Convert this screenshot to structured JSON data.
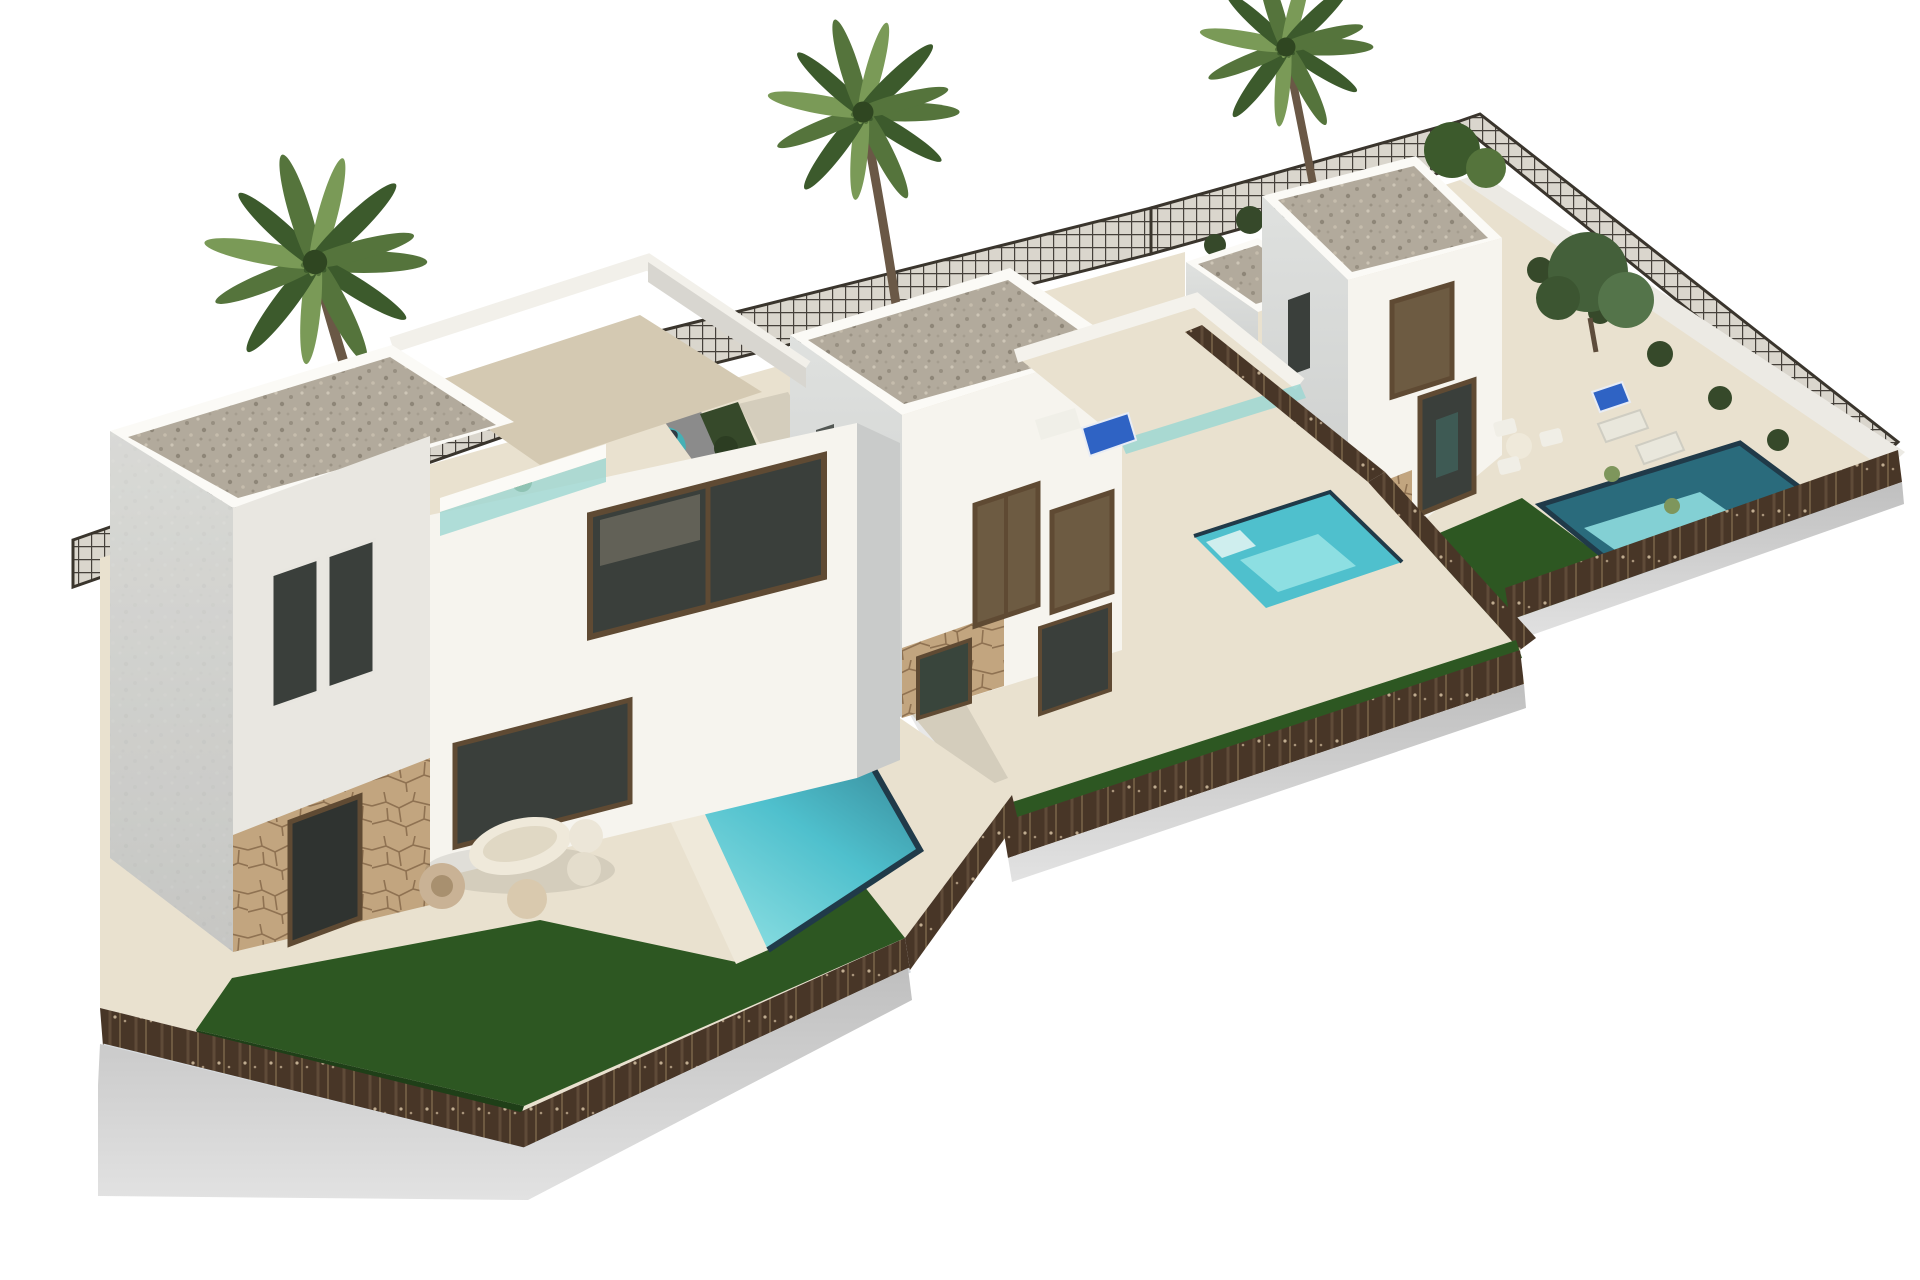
{
  "meta": {
    "description": "Aerial 3D architectural render of a residential development: three modern white two-storey villas on stepped plots, each with a private turquoise pool, artificial lawn, brown perimeter fencing on a grey concrete plinth, three palm trees, an olive tree and a teal hatchback car parked on the middle driveway. Pure white background.",
    "villa_count": 3,
    "pool_count": 3,
    "palm_tree_count": 3,
    "car_count": 1
  },
  "scene": {
    "objects": [
      "left-villa",
      "middle-villa",
      "right-villa",
      "left-pool",
      "middle-pool",
      "right-pool",
      "palm-tree-left",
      "palm-tree-middle",
      "palm-tree-right",
      "olive-tree",
      "teal-hatchback-car",
      "garden-lawn",
      "perimeter-fence",
      "mesh-fence",
      "outdoor-lounge-furniture",
      "roof-terrace",
      "sun-loungers",
      "dining-set"
    ]
  },
  "palette": {
    "bg": "#ffffff",
    "wallSun": "#f6f4ee",
    "wallLight": "#e9e7e1",
    "wallShade": "#c9cbca",
    "parapet": "#fbfaf6",
    "gravel": "#b2aa9c",
    "paving": "#e9e1cf",
    "pavingShade": "#d4c9b2",
    "stone": "#c2a57f",
    "stoneLine": "#8f7252",
    "lawn": "#2d5722",
    "lawnDark": "#1f3f18",
    "poolWater": "#4fc0cd",
    "poolLight": "#93e2e4",
    "poolDeep": "#2a6b7c",
    "poolEdge": "#203a49",
    "fence": "#483627",
    "fenceFleck": "#c0ac90",
    "mesh": "#45403a",
    "meshFill": "#dad6cd",
    "plinth": "#bfbfbf",
    "plinthLight": "#e2e2e2",
    "carBody": "#45b0b5",
    "carRoof": "#2e868e",
    "glassDark": "#3a3f3b",
    "glassBronze": "#6d5b42",
    "frameBrown": "#5f4a33",
    "glassRail": "#9ed7d2",
    "palmFrond": "#55743c",
    "palmFrondDark": "#3c5a2c",
    "palmFrondLight": "#7a9a57",
    "trunk": "#6a5846",
    "hedge": "#36492a",
    "furniture": "#efe9da",
    "furnitureTan": "#c9b295",
    "loungerBlue": "#2f63c4",
    "shadow": "#1a1a1a"
  }
}
